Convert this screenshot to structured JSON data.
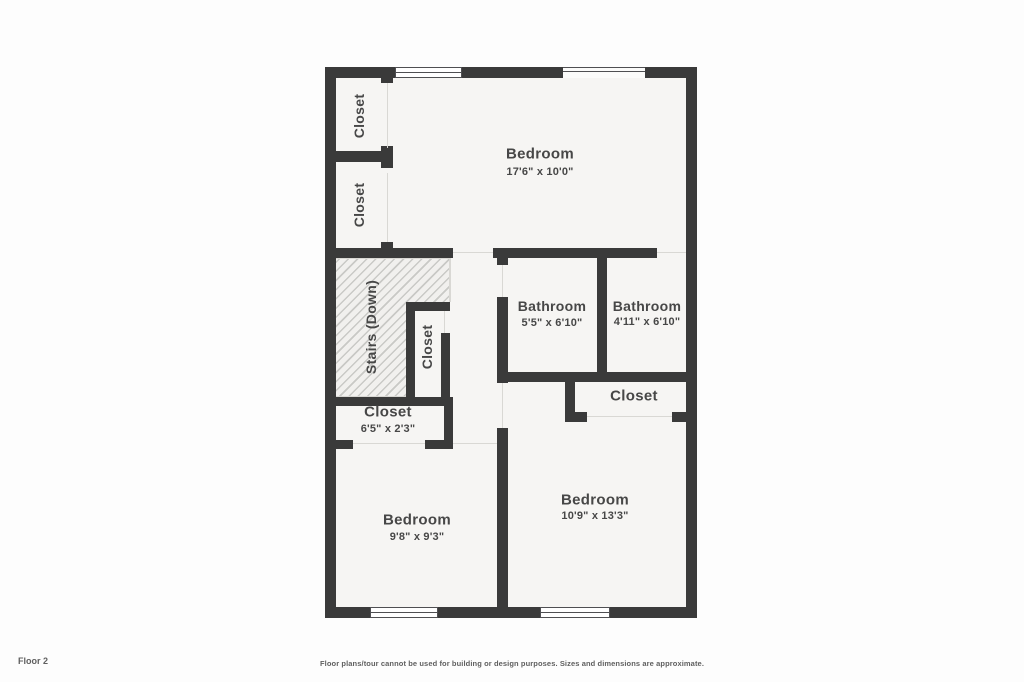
{
  "floor_plan": {
    "floor_label": "Floor 2",
    "disclaimer": "Floor plans/tour cannot be used for building or design purposes. Sizes and dimensions are approximate.",
    "rooms": {
      "bedroom_top": {
        "name": "Bedroom",
        "dims": "17'6\" x 10'0\""
      },
      "closet_top_1": {
        "name": "Closet"
      },
      "closet_top_2": {
        "name": "Closet"
      },
      "stairs": {
        "name": "Stairs (Down)"
      },
      "closet_stairs": {
        "name": "Closet"
      },
      "closet_hall": {
        "name": "Closet",
        "dims": "6'5\" x 2'3\""
      },
      "bathroom_1": {
        "name": "Bathroom",
        "dims": "5'5\" x 6'10\""
      },
      "bathroom_2": {
        "name": "Bathroom",
        "dims": "4'11\" x 6'10\""
      },
      "closet_bath": {
        "name": "Closet"
      },
      "bedroom_left": {
        "name": "Bedroom",
        "dims": "9'8\" x 9'3\""
      },
      "bedroom_right": {
        "name": "Bedroom",
        "dims": "10'9\" x 13'3\""
      }
    },
    "colors": {
      "wall": "#3a3a3a",
      "room_fill": "#f6f5f3",
      "hatch_fill": "#f1f0ee",
      "hatch_line": "#c9c9c6",
      "background": "#fdfdfd",
      "text": "#474747",
      "muted_text": "#5f5f5f",
      "opening_line": "#d9d8d4",
      "window_frame": "#4f4f52"
    }
  }
}
